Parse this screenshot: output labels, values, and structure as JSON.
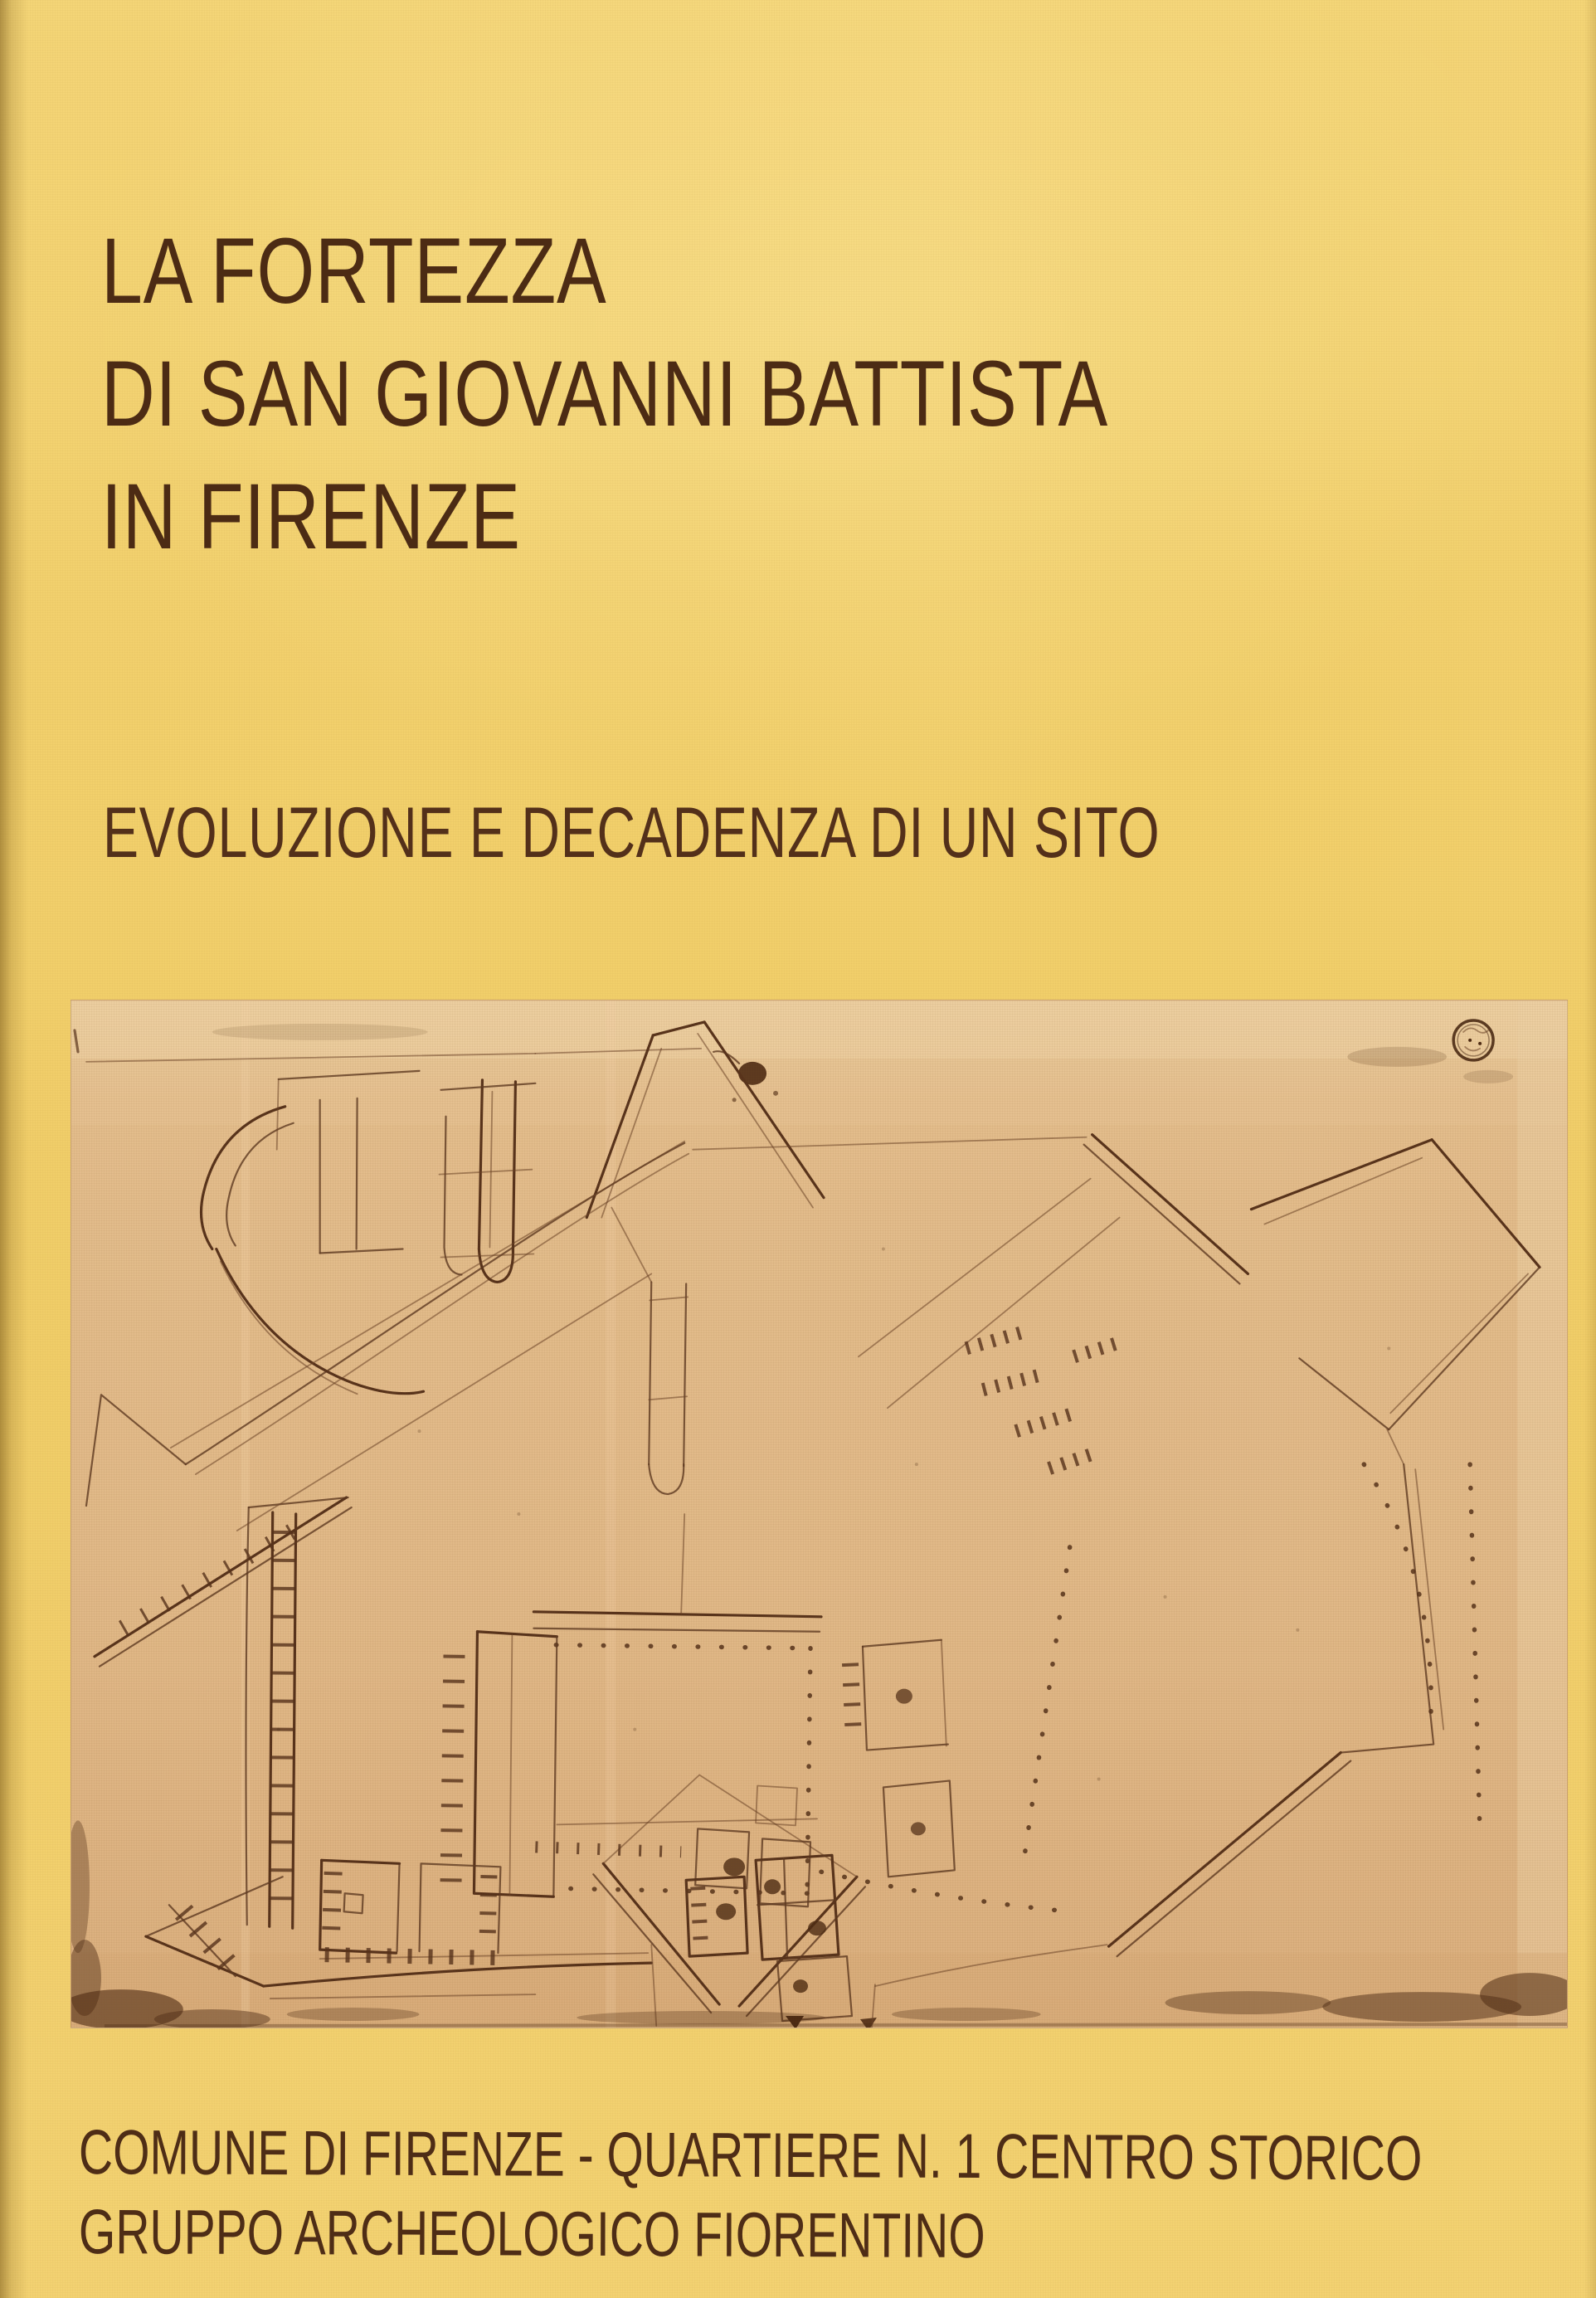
{
  "cover": {
    "title_lines": [
      "LA FORTEZZA",
      "DI SAN GIOVANNI BATTISTA",
      "IN FIRENZE"
    ],
    "subtitle": "EVOLUZIONE E DECADENZA DI UN SITO",
    "footer_lines": [
      "COMUNE DI FIRENZE - QUARTIERE N. 1 CENTRO STORICO",
      "GRUPPO ARCHEOLOGICO FIORENTINO"
    ],
    "illustration": {
      "description": "Sepia pen-and-ink plan sketch of the pentagonal fortress with corner bastions, ramparts, courtyard and buildings",
      "stamp": "circular ink stamp, upper right"
    },
    "colors": {
      "cover_background": "#f2d06e",
      "text_brown": "#4c2b14",
      "photo_paper": "#e1b988",
      "ink": "#57321b"
    }
  }
}
